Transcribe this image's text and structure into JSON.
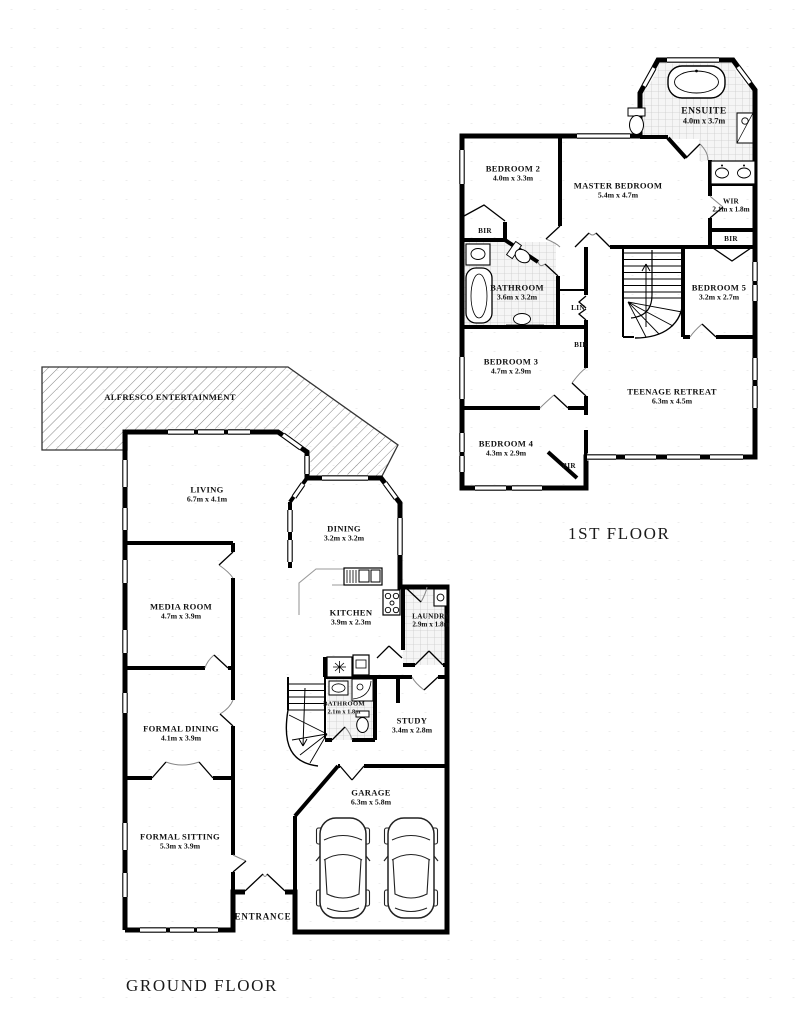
{
  "ff": {
    "title": "1ST FLOOR",
    "rooms": {
      "ensuite": {
        "name": "ENSUITE",
        "dims": "4.0m x 3.7m"
      },
      "bedroom2": {
        "name": "BEDROOM 2",
        "dims": "4.0m x 3.3m"
      },
      "master_bedroom": {
        "name": "MASTER BEDROOM",
        "dims": "5.4m x 4.7m"
      },
      "wir": {
        "name": "WIR",
        "dims": "2.1m x 1.8m"
      },
      "bathroom": {
        "name": "BATHROOM",
        "dims": "3.6m x 3.2m"
      },
      "bedroom5": {
        "name": "BEDROOM 5",
        "dims": "3.2m x 2.7m"
      },
      "bedroom3": {
        "name": "BEDROOM 3",
        "dims": "4.7m x 2.9m"
      },
      "teenage_retreat": {
        "name": "TEENAGE RETREAT",
        "dims": "6.3m x 4.5m"
      },
      "bedroom4": {
        "name": "BEDROOM 4",
        "dims": "4.3m x 2.9m"
      },
      "lin": {
        "name": "LIN"
      },
      "bir_bedroom2": {
        "name": "BIR"
      },
      "bir_wir_side": {
        "name": "BIR"
      },
      "bir_bedroom3": {
        "name": "BIR"
      },
      "bir_bedroom4": {
        "name": "BIR"
      }
    }
  },
  "gf": {
    "title": "GROUND FLOOR",
    "rooms": {
      "alfresco": {
        "name": "ALFRESCO ENTERTAINMENT"
      },
      "living": {
        "name": "LIVING",
        "dims": "6.7m x 4.1m"
      },
      "dining": {
        "name": "DINING",
        "dims": "3.2m x 3.2m"
      },
      "media_room": {
        "name": "MEDIA ROOM",
        "dims": "4.7m x 3.9m"
      },
      "kitchen": {
        "name": "KITCHEN",
        "dims": "3.9m x 2.3m"
      },
      "laundry": {
        "name": "LAUNDRY",
        "dims": "2.9m x 1.8m"
      },
      "bathroom": {
        "name": "BATHROOM",
        "dims": "2.1m x 1.8m"
      },
      "study": {
        "name": "STUDY",
        "dims": "3.4m x 2.8m"
      },
      "formal_dining": {
        "name": "FORMAL DINING",
        "dims": "4.1m x 3.9m"
      },
      "formal_sitting": {
        "name": "FORMAL SITTING",
        "dims": "5.3m x 3.9m"
      },
      "garage": {
        "name": "GARAGE",
        "dims": "6.3m x 5.8m"
      },
      "entrance": {
        "name": "ENTRANCE"
      }
    }
  },
  "colors": {
    "wall": "#000000",
    "background": "#ffffff",
    "tile_fill": "#f5f5f5",
    "tile_line": "#cccccc",
    "hatch_line": "#777777",
    "door_arc": "#888888",
    "counter_line": "#9a9a9a"
  }
}
